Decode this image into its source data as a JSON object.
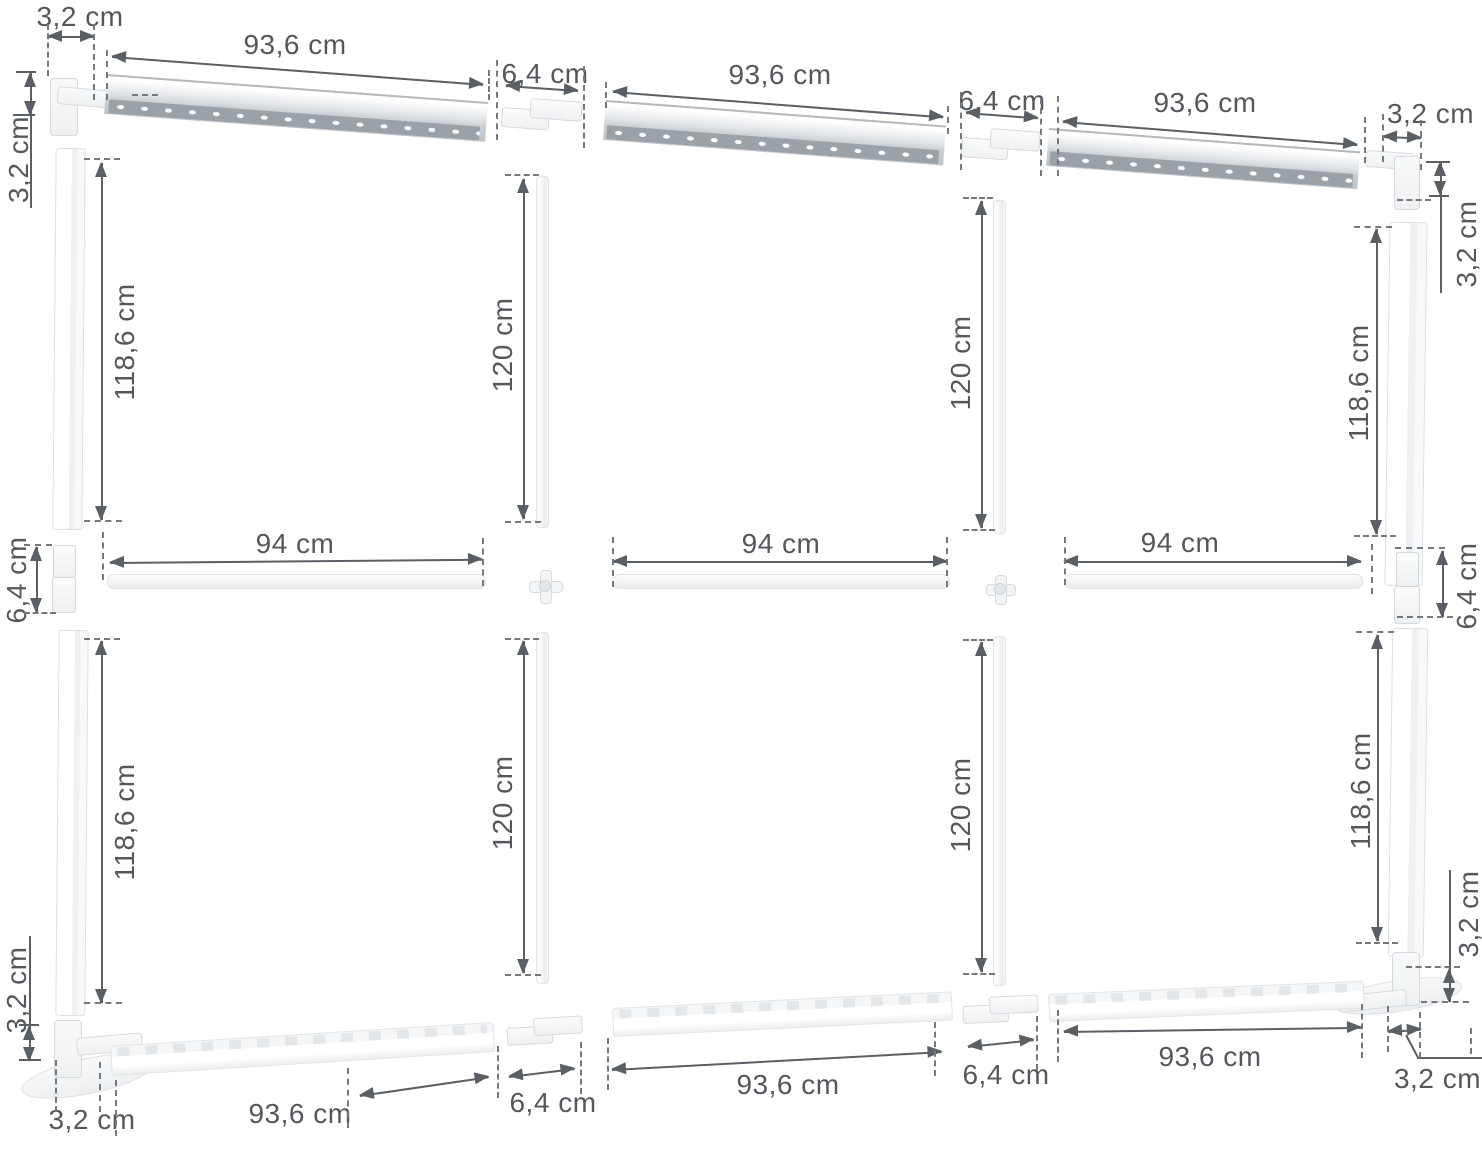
{
  "diagram": {
    "measurements": {
      "corner": "3,2 cm",
      "connector": "6,4 cm",
      "rail": "93,6 cm",
      "mid_rail": "94 cm",
      "side_panel": "118,6 cm",
      "inner_post": "120 cm"
    }
  }
}
